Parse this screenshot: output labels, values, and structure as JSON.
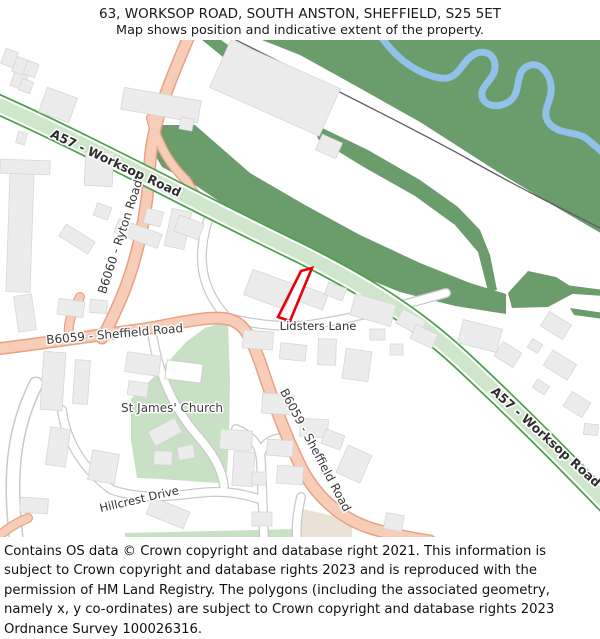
{
  "header": {
    "line1": "63, WORKSOP ROAD, SOUTH ANSTON, SHEFFIELD, S25 5ET",
    "line2": "Map shows position and indicative extent of the property."
  },
  "map": {
    "labels": {
      "a57_1": "A57 - Worksop Road",
      "a57_2": "A57 - Worksop Road",
      "b6060": "B6060 - Ryton Road",
      "b6059_1": "B6059 - Sheffield Road",
      "b6059_2": "B6059 - Sheffield Road",
      "lidsters_lane": "Lidsters Lane",
      "st_james_church": "St James' Church",
      "hillcrest_drive": "Hillcrest Drive"
    },
    "colors": {
      "background": "#ffffff",
      "a_road_fill": "#cfe6cc",
      "a_road_border": "#4ea04e",
      "b_road_fill": "#f8cdb8",
      "b_road_border": "#e9a183",
      "minor_road_fill": "#ffffff",
      "minor_road_border": "#c9c9c9",
      "forest": "#6b9c6b",
      "grass": "#c8e0c4",
      "beige": "#eae2d6",
      "water": "#92c1ea",
      "building": "#ececec",
      "building_border": "#d7d7d7",
      "railway": "#5f5f5f",
      "property_outline": "#e8000a"
    }
  },
  "footer": {
    "text": "Contains OS data © Crown copyright and database right 2021. This information is subject to Crown copyright and database rights 2023 and is reproduced with the permission of HM Land Registry. The polygons (including the associated geometry, namely x, y co-ordinates) are subject to Crown copyright and database rights 2023 Ordnance Survey 100026316."
  }
}
